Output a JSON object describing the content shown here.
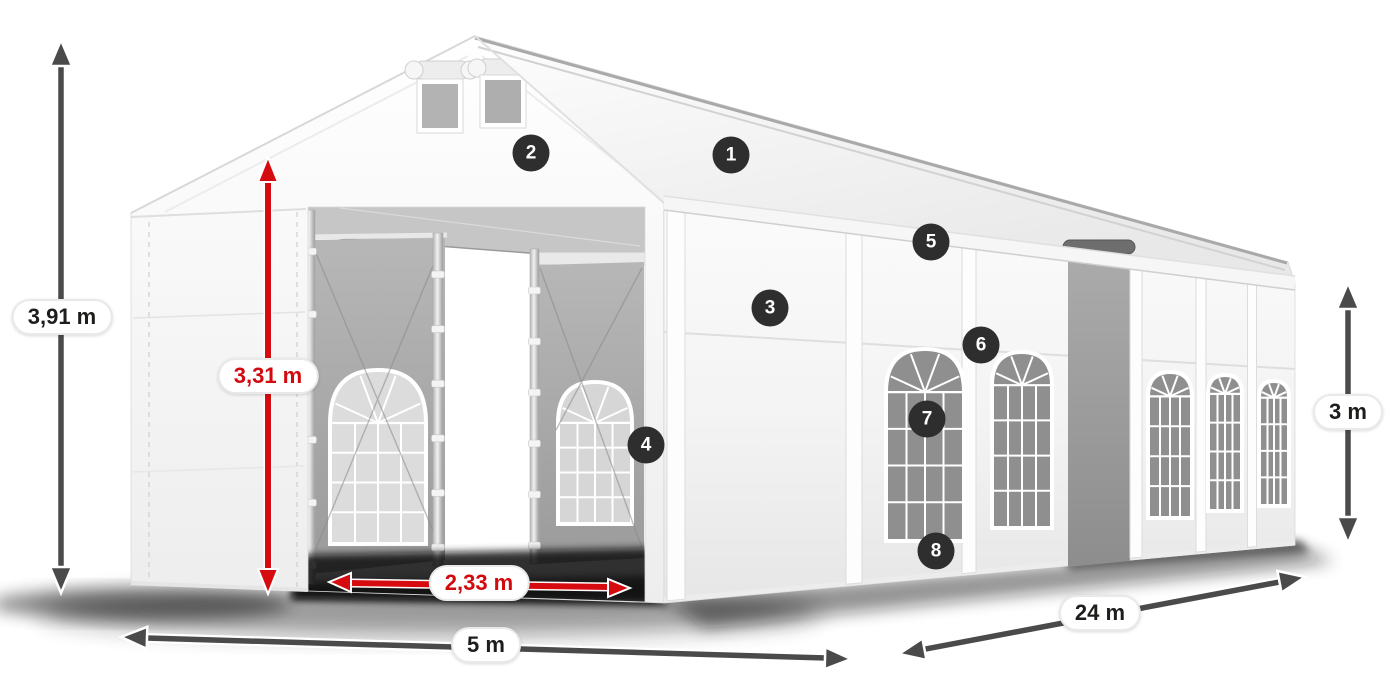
{
  "diagram": {
    "type": "product-dimension-diagram",
    "subject": "White event marquee tent with open front entrance, 5 m x 24 m"
  },
  "dimensions": {
    "total_height": "3,91 m",
    "entrance_height": "3,31 m",
    "entrance_width": "2,33 m",
    "front_width": "5 m",
    "side_length": "24 m",
    "wall_height": "3 m"
  },
  "hotspots": [
    {
      "number": "1"
    },
    {
      "number": "2"
    },
    {
      "number": "3"
    },
    {
      "number": "4"
    },
    {
      "number": "5"
    },
    {
      "number": "6"
    },
    {
      "number": "7"
    },
    {
      "number": "8"
    }
  ],
  "colors": {
    "arrow_gray": "#4a4a4a",
    "arrow_red": "#d60b10",
    "label_text_dark": "#1d1d1b",
    "label_text_red": "#d20a10",
    "badge_background": "#2e2e2e",
    "badge_text": "#ffffff",
    "pill_background": "#ffffff",
    "pill_border": "#e9e9e9",
    "background": "#ffffff"
  }
}
